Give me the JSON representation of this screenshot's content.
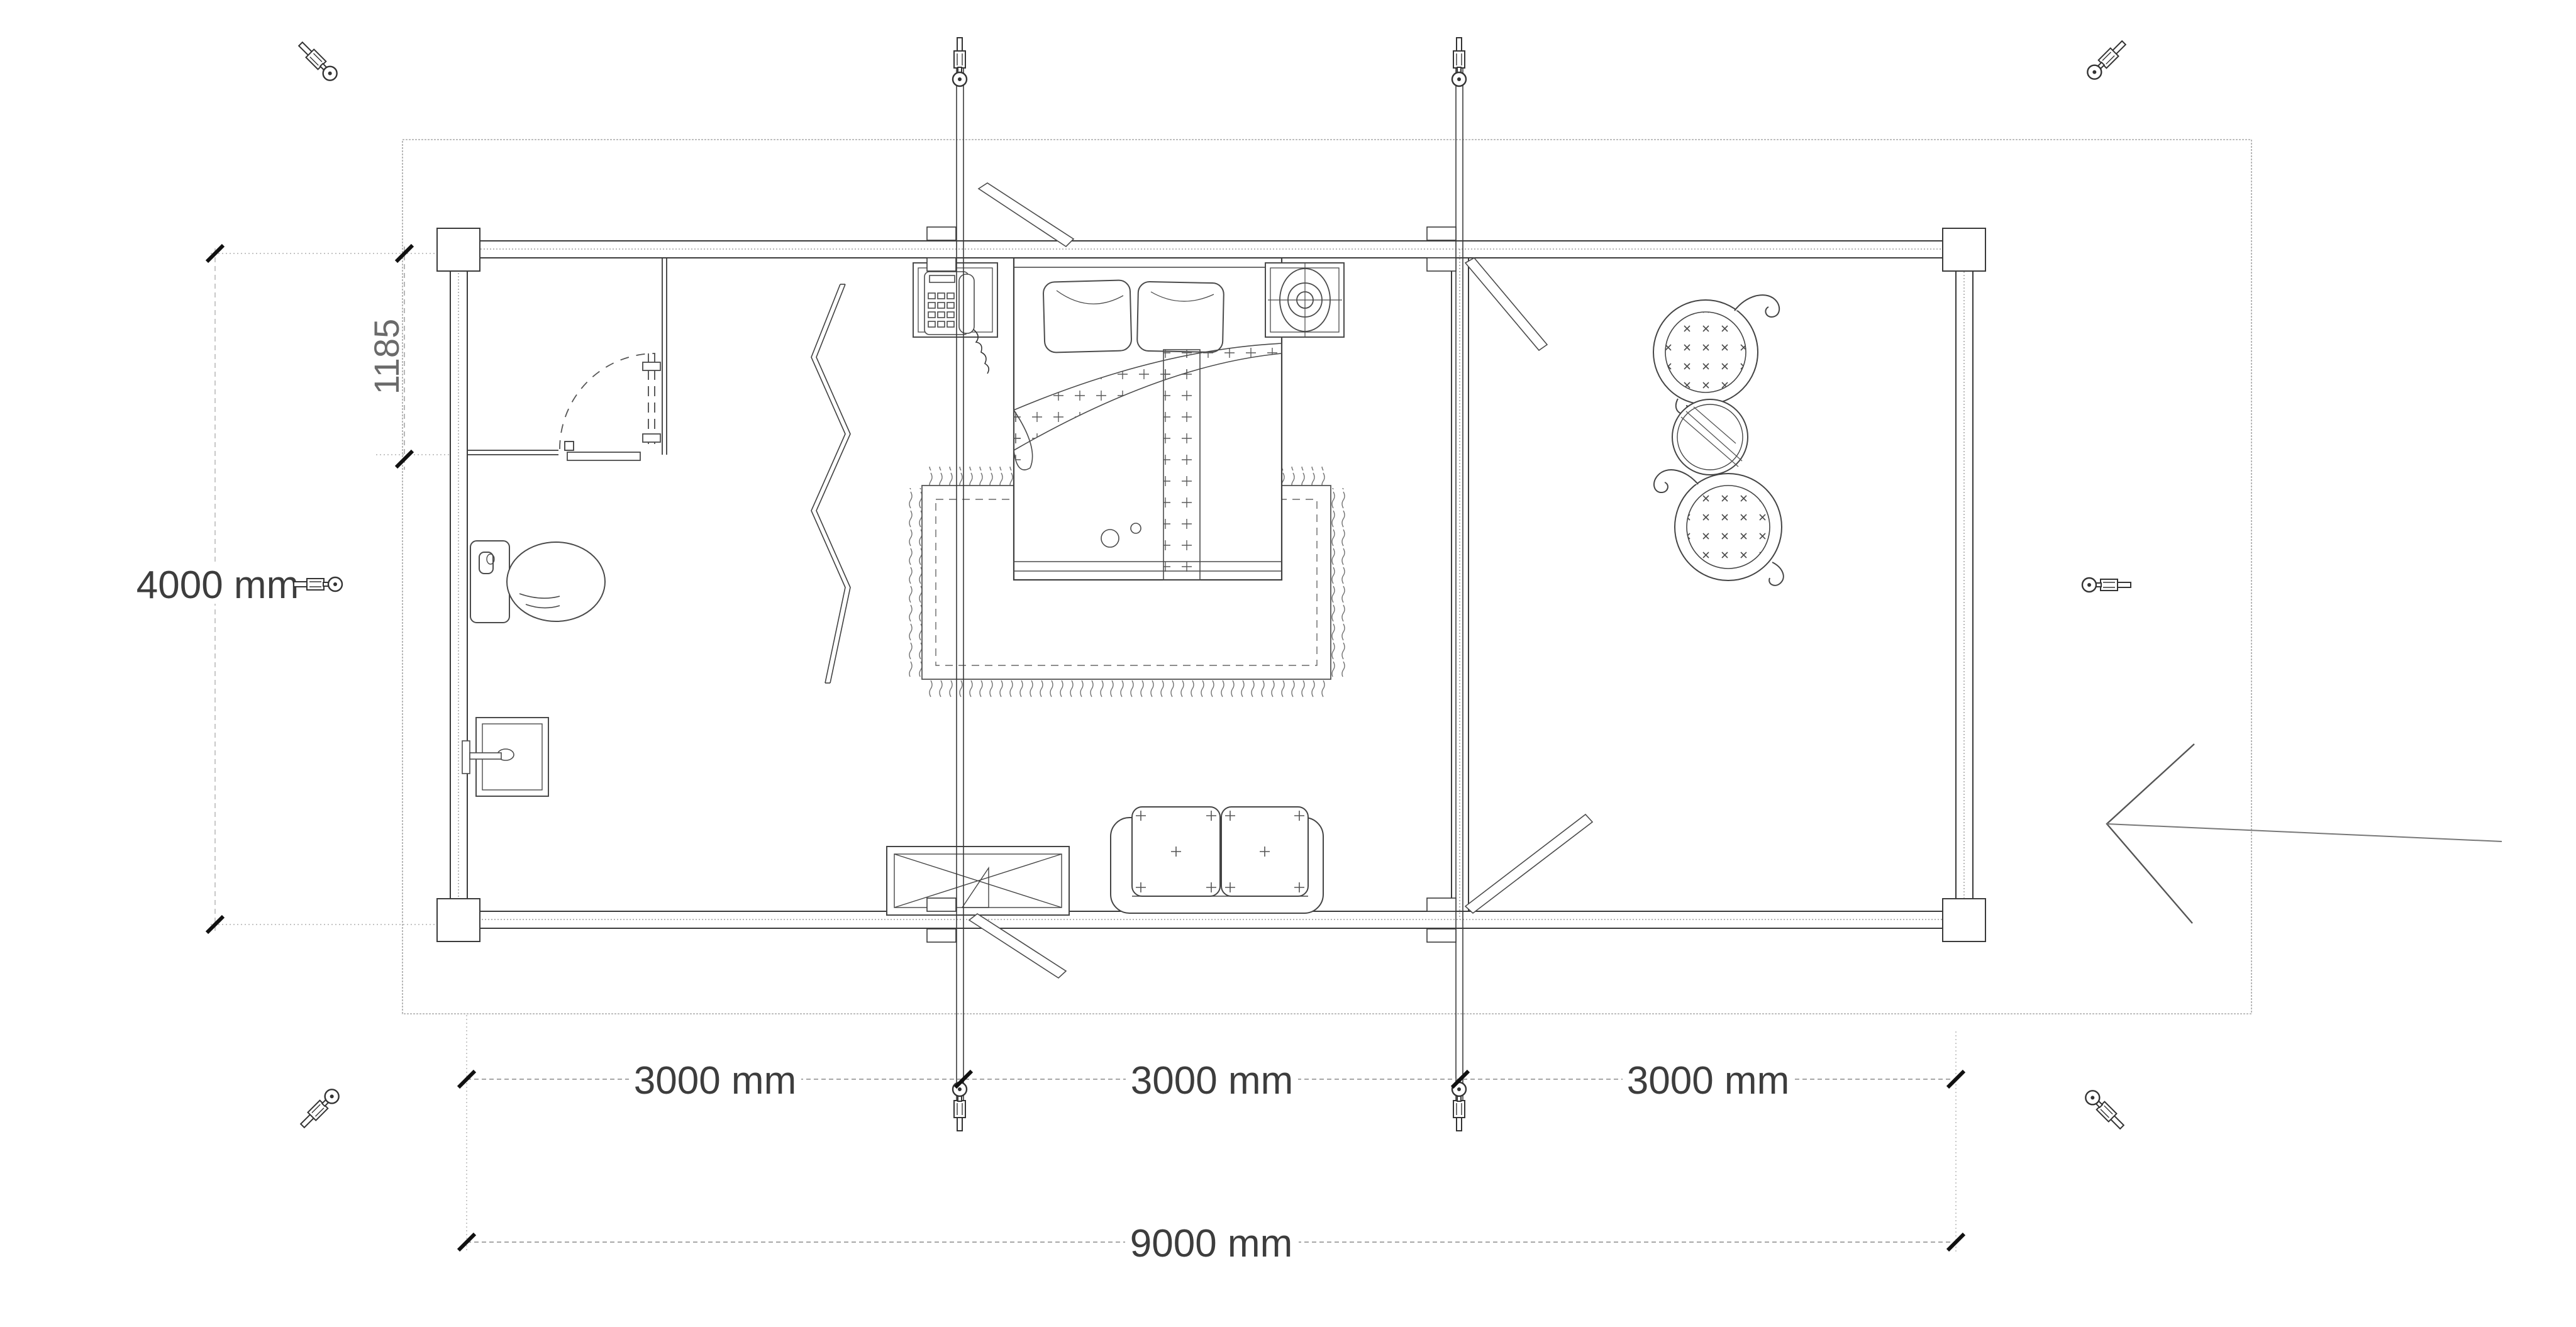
{
  "plan": {
    "type": "cabin-floor-plan",
    "labels": {
      "height": "4000 mm",
      "partition_offset": "1185",
      "bay_1": "3000 mm",
      "bay_2": "3000 mm",
      "bay_3": "3000 mm",
      "total_width": "9000 mm"
    },
    "colors": {
      "wall_line": "#3a3a3a",
      "furniture_line": "#4a4a4a",
      "deck_line": "#a8a8a8",
      "dimension_line": "#8a8a8a",
      "label_text": "#3d3d3d",
      "secondary_label_text": "#6a6a6a",
      "tick": "#111111",
      "background": "#ffffff"
    },
    "icon_names": [
      "turnbuckle-anchor-icon-top-left",
      "turnbuckle-anchor-icon-top-right",
      "turnbuckle-anchor-icon-mid-left",
      "turnbuckle-anchor-icon-mid-right",
      "turnbuckle-anchor-icon-bottom-left",
      "turnbuckle-anchor-icon-bottom-right",
      "storm-rod-end-icon-x4"
    ]
  }
}
